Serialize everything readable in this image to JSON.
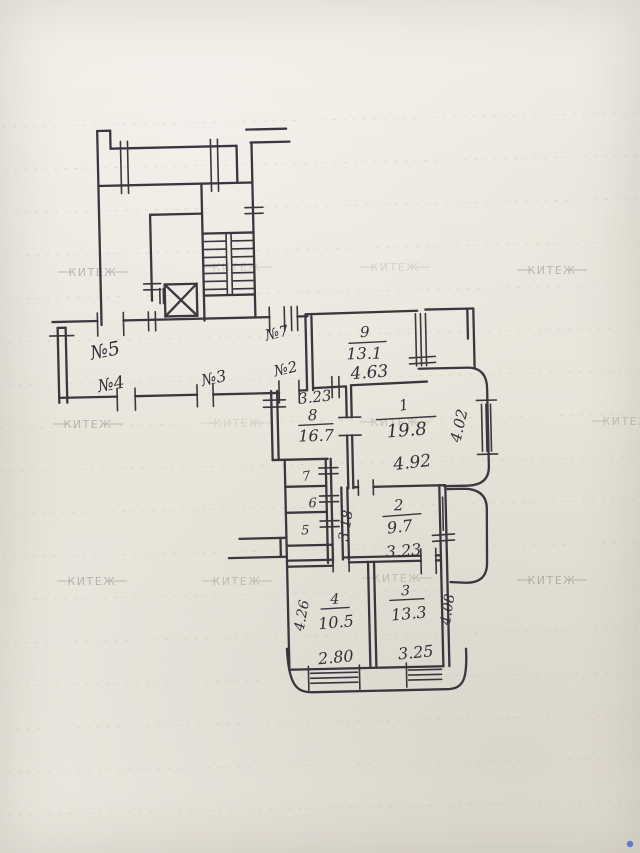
{
  "watermark": {
    "text": "КИТЕЖ"
  },
  "plan": {
    "door_labels": {
      "n5": "№5",
      "n7": "№7",
      "n4": "№4",
      "n3": "№3",
      "n2": "№2"
    },
    "rooms": {
      "r1": {
        "number": "1",
        "area": "19.8",
        "dim_bottom": "4.92",
        "dim_side": "4.02"
      },
      "r2": {
        "number": "2",
        "area": "9.7",
        "dim_bottom": "3.23",
        "dim_side": "3.18"
      },
      "r3": {
        "number": "3",
        "area": "13.3",
        "dim_bottom": "3.25",
        "dim_side": "4.08"
      },
      "r4": {
        "number": "4",
        "area": "10.5",
        "dim_bottom": "2.80",
        "dim_side": "4.26"
      },
      "r5": {
        "number": "5"
      },
      "r6": {
        "number": "6"
      },
      "r7": {
        "number": "7"
      },
      "r8": {
        "number": "8",
        "area": "16.7",
        "dim_top": "3.23"
      },
      "r9": {
        "number": "9",
        "area": "13.1",
        "dim_bottom": "4.63"
      }
    }
  },
  "colors": {
    "ink": "#312e37",
    "paper": "#e9e5dc",
    "watermark": "#84897f",
    "accent_blue": "#4a6fd0"
  }
}
